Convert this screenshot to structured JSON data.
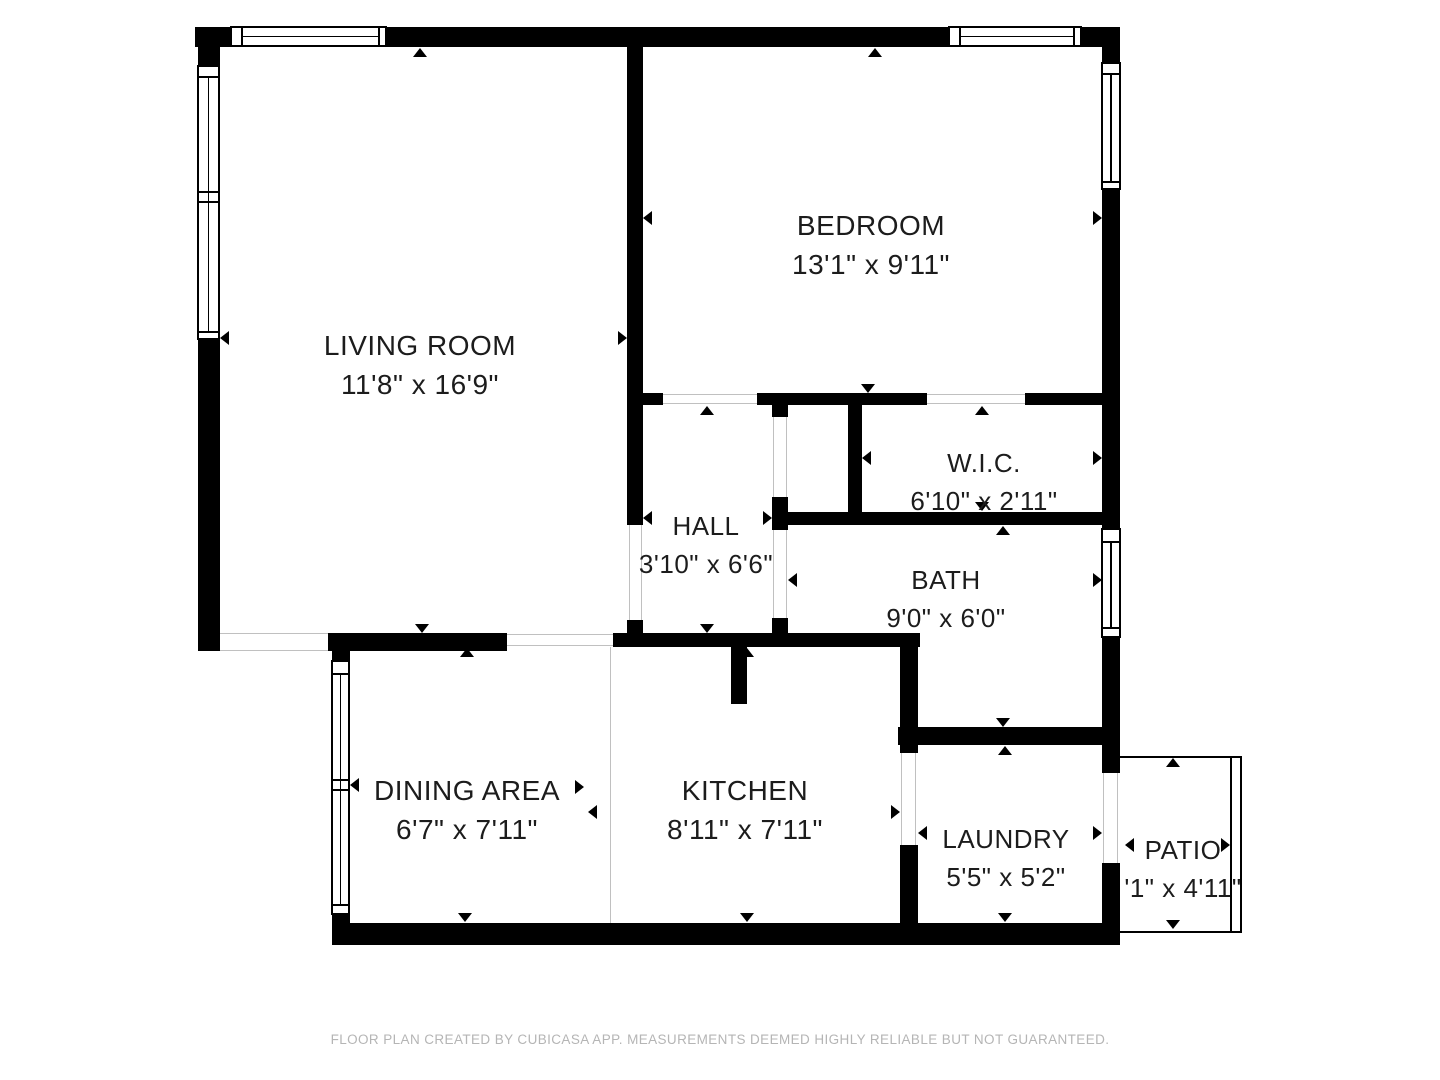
{
  "colors": {
    "wall": "#000000",
    "open_line": "#c0c0c0",
    "text": "#1c1c1c",
    "footer": "#b5b5b5",
    "background": "#ffffff"
  },
  "footer": {
    "text": "FLOOR PLAN CREATED BY CUBICASA APP. MEASUREMENTS DEEMED HIGHLY RELIABLE BUT NOT GUARANTEED."
  },
  "rooms": [
    {
      "id": "living-room",
      "name": "LIVING ROOM",
      "dims": "11'8\" x 16'9\"",
      "cx": 420,
      "top": 330,
      "font": 28
    },
    {
      "id": "bedroom",
      "name": "BEDROOM",
      "dims": "13'1\" x 9'11\"",
      "cx": 871,
      "top": 210,
      "font": 28
    },
    {
      "id": "wic",
      "name": "W.I.C.",
      "dims": "6'10\" x 2'11\"",
      "cx": 984,
      "top": 448,
      "font": 26
    },
    {
      "id": "hall",
      "name": "HALL",
      "dims": "3'10\" x 6'6\"",
      "cx": 706,
      "top": 511,
      "font": 26
    },
    {
      "id": "bath",
      "name": "BATH",
      "dims": "9'0\" x 6'0\"",
      "cx": 946,
      "top": 565,
      "font": 26
    },
    {
      "id": "dining-area",
      "name": "DINING AREA",
      "dims": "6'7\" x 7'11\"",
      "cx": 467,
      "top": 775,
      "font": 28
    },
    {
      "id": "kitchen",
      "name": "KITCHEN",
      "dims": "8'11\" x 7'11\"",
      "cx": 745,
      "top": 775,
      "font": 28
    },
    {
      "id": "laundry",
      "name": "LAUNDRY",
      "dims": "5'5\" x 5'2\"",
      "cx": 1006,
      "top": 824,
      "font": 26
    },
    {
      "id": "patio",
      "name": "PATIO",
      "dims": "'1\" x 4'11\"",
      "cx": 1183,
      "top": 835,
      "font": 26
    }
  ],
  "walls": [
    {
      "x": 195,
      "y": 27,
      "w": 35,
      "h": 20
    },
    {
      "x": 387,
      "y": 27,
      "w": 561,
      "h": 20
    },
    {
      "x": 1082,
      "y": 27,
      "w": 38,
      "h": 20
    },
    {
      "x": 198,
      "y": 27,
      "w": 22,
      "h": 38
    },
    {
      "x": 198,
      "y": 340,
      "w": 22,
      "h": 311
    },
    {
      "x": 627,
      "y": 47,
      "w": 16,
      "h": 478
    },
    {
      "x": 627,
      "y": 620,
      "w": 16,
      "h": 27
    },
    {
      "x": 1102,
      "y": 47,
      "w": 18,
      "h": 15
    },
    {
      "x": 1102,
      "y": 190,
      "w": 18,
      "h": 338
    },
    {
      "x": 1102,
      "y": 638,
      "w": 18,
      "h": 115
    },
    {
      "x": 1102,
      "y": 745,
      "w": 18,
      "h": 28
    },
    {
      "x": 1102,
      "y": 863,
      "w": 18,
      "h": 60
    },
    {
      "x": 643,
      "y": 393,
      "w": 20,
      "h": 12
    },
    {
      "x": 757,
      "y": 393,
      "w": 170,
      "h": 12
    },
    {
      "x": 1025,
      "y": 393,
      "w": 77,
      "h": 12
    },
    {
      "x": 772,
      "y": 405,
      "w": 16,
      "h": 12
    },
    {
      "x": 772,
      "y": 497,
      "w": 16,
      "h": 33
    },
    {
      "x": 772,
      "y": 618,
      "w": 16,
      "h": 29
    },
    {
      "x": 848,
      "y": 405,
      "w": 14,
      "h": 108
    },
    {
      "x": 772,
      "y": 512,
      "w": 330,
      "h": 13
    },
    {
      "x": 613,
      "y": 633,
      "w": 307,
      "h": 14
    },
    {
      "x": 900,
      "y": 647,
      "w": 18,
      "h": 106
    },
    {
      "x": 900,
      "y": 845,
      "w": 18,
      "h": 78
    },
    {
      "x": 898,
      "y": 727,
      "w": 204,
      "h": 18
    },
    {
      "x": 731,
      "y": 647,
      "w": 16,
      "h": 57
    },
    {
      "x": 328,
      "y": 633,
      "w": 179,
      "h": 18
    },
    {
      "x": 332,
      "y": 633,
      "w": 18,
      "h": 29
    },
    {
      "x": 332,
      "y": 912,
      "w": 18,
      "h": 33
    },
    {
      "x": 332,
      "y": 923,
      "w": 788,
      "h": 22
    }
  ],
  "open_lines": [
    {
      "x": 220,
      "y": 633,
      "w": 108,
      "h": 1
    },
    {
      "x": 220,
      "y": 650,
      "w": 108,
      "h": 1
    },
    {
      "x": 507,
      "y": 634,
      "w": 106,
      "h": 1
    },
    {
      "x": 507,
      "y": 645,
      "w": 106,
      "h": 1
    },
    {
      "x": 610,
      "y": 647,
      "w": 1,
      "h": 276
    },
    {
      "x": 629,
      "y": 525,
      "w": 1,
      "h": 95
    },
    {
      "x": 641,
      "y": 525,
      "w": 1,
      "h": 95
    },
    {
      "x": 773,
      "y": 417,
      "w": 1,
      "h": 80
    },
    {
      "x": 786,
      "y": 417,
      "w": 1,
      "h": 80
    },
    {
      "x": 773,
      "y": 530,
      "w": 1,
      "h": 88
    },
    {
      "x": 786,
      "y": 530,
      "w": 1,
      "h": 88
    },
    {
      "x": 901,
      "y": 753,
      "w": 1,
      "h": 92
    },
    {
      "x": 915,
      "y": 753,
      "w": 1,
      "h": 92
    },
    {
      "x": 1103,
      "y": 773,
      "w": 1,
      "h": 90
    },
    {
      "x": 1117,
      "y": 773,
      "w": 1,
      "h": 90
    },
    {
      "x": 663,
      "y": 394,
      "w": 94,
      "h": 1
    },
    {
      "x": 663,
      "y": 403,
      "w": 94,
      "h": 1
    },
    {
      "x": 927,
      "y": 394,
      "w": 98,
      "h": 1
    },
    {
      "x": 927,
      "y": 403,
      "w": 98,
      "h": 1
    }
  ],
  "windows": [
    {
      "x": 230,
      "y": 26,
      "w": 157,
      "h": 21,
      "dir": "h",
      "divs": [
        10,
        147
      ]
    },
    {
      "x": 948,
      "y": 26,
      "w": 134,
      "h": 21,
      "dir": "h",
      "divs": [
        10,
        124
      ]
    },
    {
      "x": 197,
      "y": 65,
      "w": 23,
      "h": 275,
      "dir": "v",
      "divs": [
        10,
        125,
        135,
        265
      ]
    },
    {
      "x": 331,
      "y": 660,
      "w": 19,
      "h": 255,
      "dir": "v",
      "divs": [
        12,
        118,
        128,
        243
      ]
    },
    {
      "x": 1101,
      "y": 62,
      "w": 20,
      "h": 128,
      "dir": "v",
      "divs": [
        10,
        118
      ]
    },
    {
      "x": 1101,
      "y": 528,
      "w": 20,
      "h": 110,
      "dir": "v",
      "divs": [
        12,
        98
      ]
    }
  ],
  "patio_frame": {
    "x": 1120,
    "y": 756,
    "w": 122,
    "h": 177,
    "inner_offset": 12
  },
  "ticks": [
    {
      "x": 420,
      "y": 48,
      "dir": "up"
    },
    {
      "x": 422,
      "y": 633,
      "dir": "down"
    },
    {
      "x": 220,
      "y": 338,
      "dir": "left"
    },
    {
      "x": 627,
      "y": 338,
      "dir": "right"
    },
    {
      "x": 875,
      "y": 48,
      "dir": "up"
    },
    {
      "x": 868,
      "y": 393,
      "dir": "down"
    },
    {
      "x": 643,
      "y": 218,
      "dir": "left"
    },
    {
      "x": 1102,
      "y": 218,
      "dir": "right"
    },
    {
      "x": 707,
      "y": 406,
      "dir": "up"
    },
    {
      "x": 707,
      "y": 633,
      "dir": "down"
    },
    {
      "x": 643,
      "y": 518,
      "dir": "left"
    },
    {
      "x": 772,
      "y": 518,
      "dir": "right"
    },
    {
      "x": 982,
      "y": 406,
      "dir": "up"
    },
    {
      "x": 982,
      "y": 511,
      "dir": "down"
    },
    {
      "x": 862,
      "y": 458,
      "dir": "left"
    },
    {
      "x": 1102,
      "y": 458,
      "dir": "right"
    },
    {
      "x": 1003,
      "y": 526,
      "dir": "up"
    },
    {
      "x": 1003,
      "y": 727,
      "dir": "down"
    },
    {
      "x": 788,
      "y": 580,
      "dir": "left"
    },
    {
      "x": 1102,
      "y": 580,
      "dir": "right"
    },
    {
      "x": 467,
      "y": 648,
      "dir": "up"
    },
    {
      "x": 465,
      "y": 922,
      "dir": "down"
    },
    {
      "x": 350,
      "y": 785,
      "dir": "left"
    },
    {
      "x": 584,
      "y": 787,
      "dir": "right"
    },
    {
      "x": 747,
      "y": 648,
      "dir": "up"
    },
    {
      "x": 747,
      "y": 922,
      "dir": "down"
    },
    {
      "x": 588,
      "y": 812,
      "dir": "left"
    },
    {
      "x": 900,
      "y": 812,
      "dir": "right"
    },
    {
      "x": 1005,
      "y": 746,
      "dir": "up"
    },
    {
      "x": 1005,
      "y": 922,
      "dir": "down"
    },
    {
      "x": 918,
      "y": 833,
      "dir": "left"
    },
    {
      "x": 1102,
      "y": 833,
      "dir": "right"
    },
    {
      "x": 1173,
      "y": 758,
      "dir": "up"
    },
    {
      "x": 1173,
      "y": 929,
      "dir": "down"
    },
    {
      "x": 1125,
      "y": 845,
      "dir": "left"
    },
    {
      "x": 1230,
      "y": 845,
      "dir": "right"
    }
  ]
}
